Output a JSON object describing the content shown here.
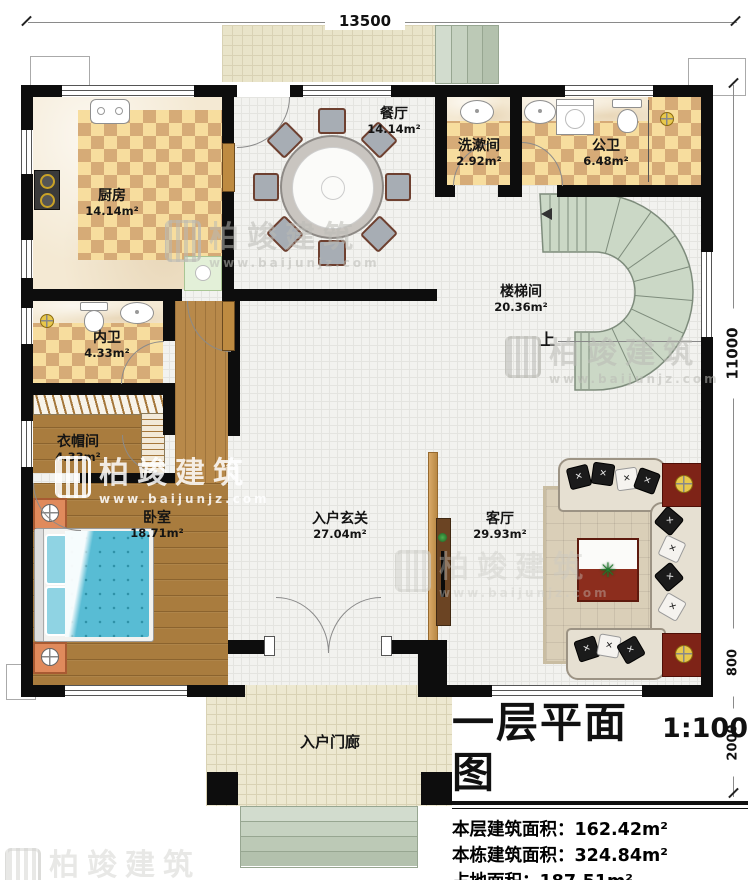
{
  "dimensions": {
    "top": "13500",
    "right_total": "11000",
    "right_bay": "800",
    "right_porch": "2000"
  },
  "rooms": {
    "kitchen": {
      "name": "厨房",
      "area": "14.14m²"
    },
    "dining": {
      "name": "餐厅",
      "area": "14.14m²"
    },
    "washroom": {
      "name": "洗漱间",
      "area": "2.92m²"
    },
    "public_bath": {
      "name": "公卫",
      "area": "6.48m²"
    },
    "stairwell": {
      "name": "楼梯间",
      "area": "20.36m²"
    },
    "private_bath": {
      "name": "内卫",
      "area": "4.33m²"
    },
    "cloakroom": {
      "name": "衣帽间",
      "area": "4.33m²"
    },
    "bedroom": {
      "name": "卧室",
      "area": "18.71m²"
    },
    "foyer": {
      "name": "入户玄关",
      "area": "27.04m²"
    },
    "living": {
      "name": "客厅",
      "area": "29.93m²"
    },
    "porch": {
      "name": "入户门廊"
    }
  },
  "stairs": {
    "up_label": "上"
  },
  "watermark": {
    "name": "柏竣建筑",
    "url": "www.baijunjz.com"
  },
  "title_block": {
    "title": "一层平面图",
    "scale": "1:100",
    "stats": [
      {
        "label": "本层建筑面积：",
        "value": "162.42m²"
      },
      {
        "label": "本栋建筑面积：",
        "value": "324.84m²"
      },
      {
        "label": "占地面积：",
        "value": "187.51m²"
      },
      {
        "label": "层高：",
        "value": "3.6m"
      }
    ]
  },
  "colors": {
    "wall": "#0d0d0d",
    "checker_light": "#f7dd9e",
    "checker_dark": "#d6ab77",
    "wood": "#A97C3E",
    "stairs": "#CBD8C6",
    "bed": "#58BCD4",
    "accent_red": "#7E2317"
  }
}
